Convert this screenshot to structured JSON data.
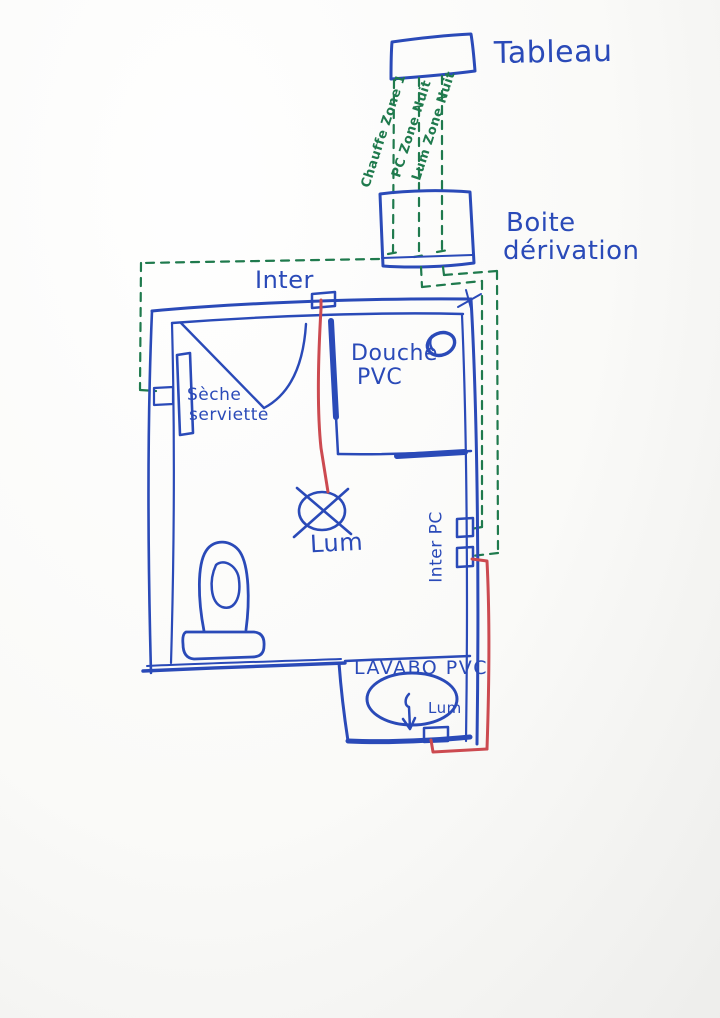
{
  "colors": {
    "ink_blue": "#2a4ab8",
    "ink_green": "#1f7a4d",
    "ink_red": "#cc4a50"
  },
  "labels": {
    "tableau": "Tableau",
    "boite_line1": "Boite",
    "boite_line2": "dérivation",
    "circuit_chauffe": "Chauffe Zone 1",
    "circuit_pc": "PC Zone Nuit",
    "circuit_lum": "Lum Zone Nuit",
    "inter": "Inter",
    "douche_line1": "Douche",
    "douche_line2": "PVC",
    "seche_line1": "Sèche",
    "seche_line2": "serviette",
    "lum_main": "Lum",
    "inter_pc": "Inter PC",
    "lavabo": "LAVABO PVC",
    "lum_sink": "Lum"
  }
}
